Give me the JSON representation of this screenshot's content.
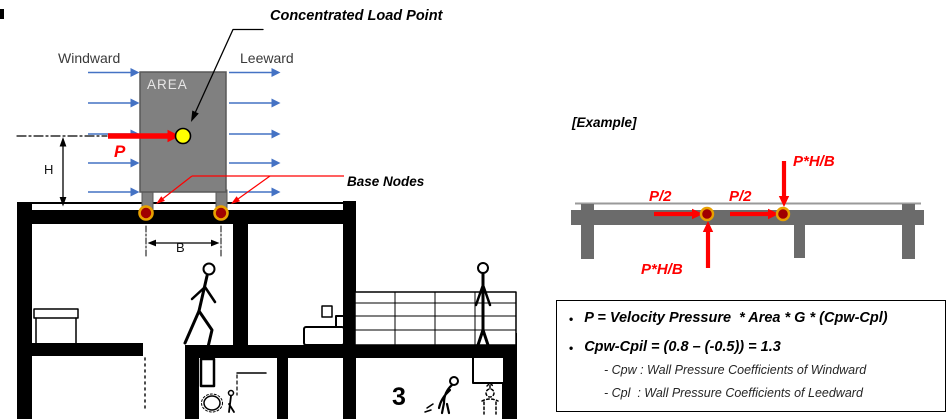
{
  "scene": {
    "windward": "Windward",
    "leeward": "Leeward",
    "area": "AREA",
    "concentrated_load": "Concentrated Load Point",
    "base_nodes": "Base Nodes",
    "p": "P",
    "h": "H",
    "b": "B",
    "floor_number": "3"
  },
  "example": {
    "title": "[Example]",
    "p_half_left": "P/2",
    "p_half_right": "P/2",
    "phb_top": "P*H/B",
    "phb_bottom": "P*H/B"
  },
  "formula_box": {
    "bullet": "•",
    "line1": "P = Velocity Pressure  * Area * G * (Cpw-Cpl)",
    "line2": "Cpw-Cpil = (0.8 – (-0.5)) = 1.3",
    "note1": "- Cpw : Wall Pressure Coefficients of Windward",
    "note2": "- Cpl  : Wall Pressure Coefficients of Leedward"
  },
  "colors": {
    "wind-arrow": "#4472C4",
    "force-red": "#FF0000",
    "struct-gray": "#808080",
    "struct-gray-edge": "#595959",
    "beam-gray": "#6B6B6B",
    "node-red": "#A00000",
    "node-ring": "#E8A000",
    "point-yellow": "#FFFF00",
    "area-text": "#E7E6E6"
  }
}
